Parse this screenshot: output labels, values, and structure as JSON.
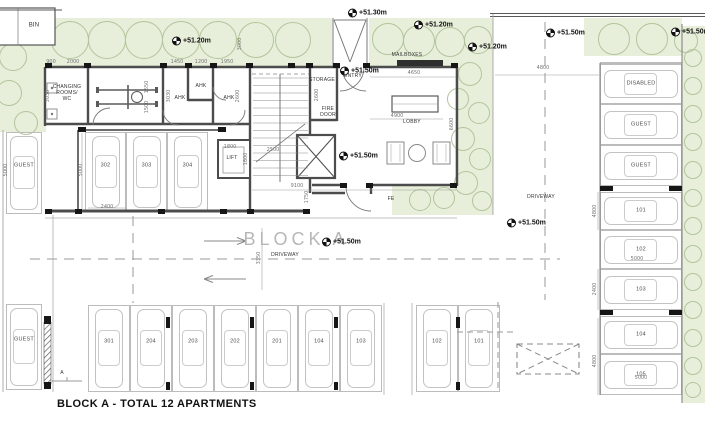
{
  "title": "BLOCK A - TOTAL 12 APARTMENTS",
  "colors": {
    "landscape_green": "#e7efda",
    "tree_outline": "#b3c49c",
    "wall": "#4c4c4c",
    "car_outline": "#c3c3c3",
    "dim_text": "#767676",
    "block_title_gray": "#b7b7b7"
  },
  "labels": [
    {
      "t": "BIN",
      "x": 34,
      "y": 26
    },
    {
      "t": "CHANGING\nROOMS/\nWC",
      "x": 67,
      "y": 93,
      "cls": "tiny"
    },
    {
      "t": "AHK",
      "x": 180,
      "y": 98,
      "cls": "tiny"
    },
    {
      "t": "AHK",
      "x": 201,
      "y": 86,
      "cls": "tiny"
    },
    {
      "t": "AHK",
      "x": 229,
      "y": 98,
      "cls": "tiny"
    },
    {
      "t": "STORAGE",
      "x": 322,
      "y": 80,
      "cls": "tiny"
    },
    {
      "t": "ENTRY",
      "x": 353,
      "y": 76,
      "cls": "tiny"
    },
    {
      "t": "FIRE\nDOOR",
      "x": 328,
      "y": 112,
      "cls": "tiny"
    },
    {
      "t": "LIFT",
      "x": 232,
      "y": 158,
      "cls": "tiny"
    },
    {
      "t": "LOBBY",
      "x": 412,
      "y": 122,
      "cls": "tiny"
    },
    {
      "t": "MAILBOXES",
      "x": 407,
      "y": 55,
      "cls": "tiny"
    },
    {
      "t": "FE",
      "x": 391,
      "y": 199,
      "cls": "tiny"
    },
    {
      "t": "DRIVEWAY",
      "x": 285,
      "y": 255,
      "cls": "tiny"
    },
    {
      "t": "DRIVEWAY",
      "x": 541,
      "y": 197,
      "cls": "tiny"
    },
    {
      "t": "BLOCK A",
      "x": 296,
      "y": 240,
      "cls": "big"
    },
    {
      "t": "A",
      "x": 62,
      "y": 373,
      "cls": "tiny"
    }
  ],
  "spot_levels": [
    {
      "t": "+51.30m",
      "x": 348,
      "y": 13
    },
    {
      "t": "+51.20m",
      "x": 172,
      "y": 41
    },
    {
      "t": "+51.20m",
      "x": 414,
      "y": 25
    },
    {
      "t": "+51.20m",
      "x": 468,
      "y": 47
    },
    {
      "t": "+51.50m",
      "x": 546,
      "y": 33
    },
    {
      "t": "+51.50m",
      "x": 671,
      "y": 32
    },
    {
      "t": "+51.50m",
      "x": 340,
      "y": 71
    },
    {
      "t": "+51.50m",
      "x": 339,
      "y": 156
    },
    {
      "t": "+51.50m",
      "x": 322,
      "y": 242
    },
    {
      "t": "+51.50m",
      "x": 507,
      "y": 223
    }
  ],
  "dimensions": [
    {
      "t": "900",
      "x": 51,
      "y": 62
    },
    {
      "t": "2000",
      "x": 73,
      "y": 62
    },
    {
      "t": "1450",
      "x": 177,
      "y": 62
    },
    {
      "t": "1200",
      "x": 201,
      "y": 62
    },
    {
      "t": "1950",
      "x": 227,
      "y": 62
    },
    {
      "t": "3000",
      "x": 240,
      "y": 44,
      "v": true
    },
    {
      "t": "1550",
      "x": 147,
      "y": 87,
      "v": true
    },
    {
      "t": "1500",
      "x": 147,
      "y": 107,
      "v": true
    },
    {
      "t": "3030",
      "x": 169,
      "y": 96,
      "v": true
    },
    {
      "t": "3030",
      "x": 48,
      "y": 96,
      "v": true
    },
    {
      "t": "2600",
      "x": 238,
      "y": 96,
      "v": true
    },
    {
      "t": "2600",
      "x": 317,
      "y": 95,
      "v": true
    },
    {
      "t": "1800",
      "x": 230,
      "y": 147
    },
    {
      "t": "1800",
      "x": 246,
      "y": 159,
      "v": true
    },
    {
      "t": "2500",
      "x": 273,
      "y": 150
    },
    {
      "t": "9100",
      "x": 297,
      "y": 186
    },
    {
      "t": "1750",
      "x": 307,
      "y": 197,
      "v": true
    },
    {
      "t": "4650",
      "x": 414,
      "y": 73
    },
    {
      "t": "4900",
      "x": 397,
      "y": 116
    },
    {
      "t": "6600",
      "x": 452,
      "y": 124,
      "v": true
    },
    {
      "t": "4800",
      "x": 543,
      "y": 68
    },
    {
      "t": "4800",
      "x": 595,
      "y": 211,
      "v": true
    },
    {
      "t": "5000",
      "x": 637,
      "y": 259
    },
    {
      "t": "2400",
      "x": 595,
      "y": 289,
      "v": true
    },
    {
      "t": "4800",
      "x": 595,
      "y": 361,
      "v": true
    },
    {
      "t": "5000",
      "x": 641,
      "y": 378
    },
    {
      "t": "5000",
      "x": 81,
      "y": 170,
      "v": true
    },
    {
      "t": "5000",
      "x": 6,
      "y": 170,
      "v": true
    },
    {
      "t": "2400",
      "x": 107,
      "y": 207
    },
    {
      "t": "3350",
      "x": 259,
      "y": 258,
      "v": true
    }
  ],
  "parking": {
    "spaces": [
      {
        "label": "GUEST",
        "x": 6,
        "y": 132,
        "w": 36,
        "h": 82,
        "dir": "v"
      },
      {
        "label": "GUEST",
        "x": 6,
        "y": 304,
        "w": 36,
        "h": 86,
        "dir": "v"
      },
      {
        "label": "302",
        "x": 85,
        "y": 132,
        "w": 41,
        "h": 80,
        "dir": "v"
      },
      {
        "label": "303",
        "x": 126,
        "y": 132,
        "w": 41,
        "h": 80,
        "dir": "v"
      },
      {
        "label": "304",
        "x": 167,
        "y": 132,
        "w": 41,
        "h": 80,
        "dir": "v"
      },
      {
        "label": "301",
        "x": 88,
        "y": 305,
        "w": 42,
        "h": 87,
        "dir": "v"
      },
      {
        "label": "204",
        "x": 130,
        "y": 305,
        "w": 42,
        "h": 87,
        "dir": "v"
      },
      {
        "label": "203",
        "x": 172,
        "y": 305,
        "w": 42,
        "h": 87,
        "dir": "v"
      },
      {
        "label": "202",
        "x": 214,
        "y": 305,
        "w": 42,
        "h": 87,
        "dir": "v"
      },
      {
        "label": "201",
        "x": 256,
        "y": 305,
        "w": 42,
        "h": 87,
        "dir": "v"
      },
      {
        "label": "104",
        "x": 298,
        "y": 305,
        "w": 42,
        "h": 87,
        "dir": "v"
      },
      {
        "label": "103",
        "x": 340,
        "y": 305,
        "w": 42,
        "h": 87,
        "dir": "v"
      },
      {
        "label": "102",
        "x": 416,
        "y": 305,
        "w": 42,
        "h": 87,
        "dir": "v"
      },
      {
        "label": "101",
        "x": 458,
        "y": 305,
        "w": 42,
        "h": 87,
        "dir": "v"
      },
      {
        "label": "DISABLED",
        "x": 600,
        "y": 64,
        "w": 82,
        "h": 40,
        "dir": "h"
      },
      {
        "label": "GUEST",
        "x": 600,
        "y": 104,
        "w": 82,
        "h": 41,
        "dir": "h"
      },
      {
        "label": "GUEST",
        "x": 600,
        "y": 145,
        "w": 82,
        "h": 41,
        "dir": "h"
      },
      {
        "label": "101",
        "x": 600,
        "y": 192,
        "w": 82,
        "h": 38,
        "dir": "h"
      },
      {
        "label": "102",
        "x": 600,
        "y": 230,
        "w": 82,
        "h": 39,
        "dir": "h"
      },
      {
        "label": "103",
        "x": 600,
        "y": 269,
        "w": 82,
        "h": 41,
        "dir": "h"
      },
      {
        "label": "104",
        "x": 600,
        "y": 316,
        "w": 82,
        "h": 38,
        "dir": "h"
      },
      {
        "label": "105",
        "x": 600,
        "y": 354,
        "w": 82,
        "h": 41,
        "dir": "h"
      }
    ]
  },
  "landscape": {
    "areas": [
      {
        "x": 28,
        "y": 18,
        "w": 462,
        "h": 49
      },
      {
        "x": 0,
        "y": 18,
        "w": 46,
        "h": 114
      },
      {
        "x": 455,
        "y": 18,
        "w": 38,
        "h": 197
      },
      {
        "x": 392,
        "y": 186,
        "w": 101,
        "h": 29
      },
      {
        "x": 584,
        "y": 18,
        "w": 98,
        "h": 38
      },
      {
        "x": 682,
        "y": 26,
        "w": 23,
        "h": 377
      }
    ],
    "trees": [
      {
        "x": 70,
        "y": 40,
        "r": 19
      },
      {
        "x": 107,
        "y": 40,
        "r": 19
      },
      {
        "x": 144,
        "y": 40,
        "r": 19
      },
      {
        "x": 181,
        "y": 40,
        "r": 19
      },
      {
        "x": 218,
        "y": 40,
        "r": 19
      },
      {
        "x": 256,
        "y": 40,
        "r": 18
      },
      {
        "x": 293,
        "y": 40,
        "r": 18
      },
      {
        "x": 388,
        "y": 39,
        "r": 16
      },
      {
        "x": 419,
        "y": 41,
        "r": 16
      },
      {
        "x": 450,
        "y": 42,
        "r": 15
      },
      {
        "x": 478,
        "y": 40,
        "r": 14
      },
      {
        "x": 13,
        "y": 57,
        "r": 14
      },
      {
        "x": 9,
        "y": 93,
        "r": 13
      },
      {
        "x": 26,
        "y": 123,
        "r": 12
      },
      {
        "x": 470,
        "y": 74,
        "r": 12
      },
      {
        "x": 458,
        "y": 99,
        "r": 11
      },
      {
        "x": 479,
        "y": 113,
        "r": 11
      },
      {
        "x": 463,
        "y": 139,
        "r": 12
      },
      {
        "x": 480,
        "y": 159,
        "r": 11
      },
      {
        "x": 466,
        "y": 183,
        "r": 12
      },
      {
        "x": 444,
        "y": 198,
        "r": 11
      },
      {
        "x": 420,
        "y": 200,
        "r": 11
      },
      {
        "x": 482,
        "y": 201,
        "r": 10
      },
      {
        "x": 614,
        "y": 39,
        "r": 16
      },
      {
        "x": 652,
        "y": 39,
        "r": 16
      },
      {
        "x": 686,
        "y": 41,
        "r": 12
      },
      {
        "x": 693,
        "y": 58,
        "r": 9
      },
      {
        "x": 693,
        "y": 86,
        "r": 9
      },
      {
        "x": 693,
        "y": 114,
        "r": 9
      },
      {
        "x": 693,
        "y": 142,
        "r": 9
      },
      {
        "x": 693,
        "y": 170,
        "r": 9
      },
      {
        "x": 693,
        "y": 198,
        "r": 9
      },
      {
        "x": 693,
        "y": 226,
        "r": 9
      },
      {
        "x": 693,
        "y": 254,
        "r": 9
      },
      {
        "x": 693,
        "y": 282,
        "r": 9
      },
      {
        "x": 693,
        "y": 310,
        "r": 9
      },
      {
        "x": 693,
        "y": 338,
        "r": 9
      },
      {
        "x": 693,
        "y": 366,
        "r": 9
      },
      {
        "x": 693,
        "y": 390,
        "r": 8
      }
    ]
  }
}
